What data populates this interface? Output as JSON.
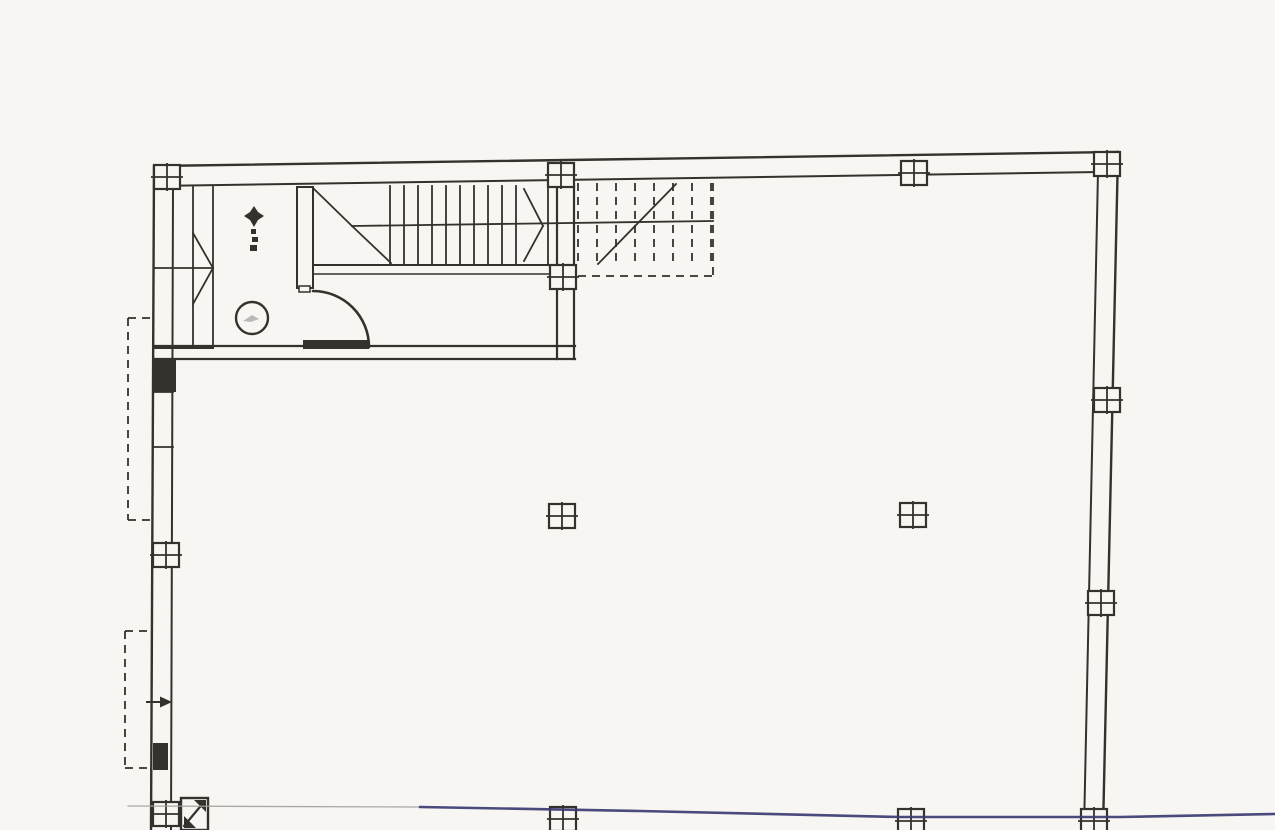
{
  "meta": {
    "width": 1275,
    "height": 830,
    "paper_color": "#f7f6f3",
    "ink_color": "#35312d",
    "pen_blue_color": "#3b3b72",
    "pen_gray_color": "#a0a09c",
    "drawing_type": "scanned-floor-plan",
    "visible_text": []
  },
  "floorplan": {
    "lines": [
      {
        "n": "top-wall-outer",
        "p": [
          155,
          166,
          1118,
          152
        ],
        "w": 2.4
      },
      {
        "n": "top-wall-inner",
        "p": [
          155,
          186,
          1098,
          172
        ],
        "w": 2
      },
      {
        "n": "right-wall-outer",
        "p": [
          1118,
          152,
          1103,
          830
        ],
        "w": 2.4
      },
      {
        "n": "right-wall-inner",
        "p": [
          1098,
          172,
          1084,
          830
        ],
        "w": 2
      },
      {
        "n": "left-wall-outer",
        "p": [
          154,
          166,
          151,
          830
        ],
        "w": 2.4
      },
      {
        "n": "left-wall-inner",
        "p": [
          173,
          186,
          171,
          830
        ],
        "w": 2
      },
      {
        "n": "lobby-south-wall-top-left",
        "p": [
          154,
          346,
          307,
          346
        ],
        "w": 2.2
      },
      {
        "n": "lobby-south-wall-top-right",
        "p": [
          368,
          346,
          575,
          346
        ],
        "w": 2.2
      },
      {
        "n": "lobby-south-wall-bottom",
        "p": [
          154,
          359,
          575,
          359
        ],
        "w": 2.2
      },
      {
        "n": "lobby-east-wall-outer",
        "p": [
          574,
          186,
          574,
          359
        ],
        "w": 2.2
      },
      {
        "n": "lobby-east-wall-inner",
        "p": [
          557,
          186,
          557,
          359
        ],
        "w": 2.2
      },
      {
        "n": "left-wall-division",
        "p": [
          154,
          392,
          173,
          392
        ],
        "w": 1.8
      },
      {
        "n": "left-wall-division",
        "p": [
          154,
          447,
          173,
          447
        ],
        "w": 1.8
      },
      {
        "n": "stair-strip-line",
        "p": [
          193,
          187,
          193,
          348
        ],
        "w": 1.8
      },
      {
        "n": "stair-strip-line",
        "p": [
          213,
          187,
          213,
          348
        ],
        "w": 1.8
      },
      {
        "n": "stair-strip-mid-line",
        "p": [
          154,
          268,
          213,
          268
        ],
        "w": 1.8
      },
      {
        "n": "stair-strip-break-line",
        "p": [
          193,
          233,
          213,
          268
        ],
        "w": 1.8
      },
      {
        "n": "stair-strip-break-line",
        "p": [
          193,
          304,
          213,
          268
        ],
        "w": 1.8
      },
      {
        "n": "stair-strip-bottom-line",
        "p": [
          154,
          348,
          213,
          348
        ],
        "w": 2
      },
      {
        "n": "stair-flight-bottom-line",
        "p": [
          313,
          265,
          557,
          265
        ],
        "w": 2
      },
      {
        "n": "stair-landing-line",
        "p": [
          313,
          274,
          552,
          274
        ],
        "w": 1.6
      },
      {
        "n": "stair-mid-line",
        "p": [
          352,
          226,
          713,
          221
        ],
        "w": 1.8
      },
      {
        "n": "stair-break-line",
        "p": [
          313,
          188,
          352,
          226
        ],
        "w": 1.8
      },
      {
        "n": "stair-break-line",
        "p": [
          352,
          226,
          391,
          263
        ],
        "w": 1.8
      },
      {
        "n": "stair-break-line",
        "p": [
          524,
          189,
          543,
          226
        ],
        "w": 1.8
      },
      {
        "n": "stair-break-line",
        "p": [
          543,
          226,
          524,
          261
        ],
        "w": 1.8
      },
      {
        "n": "stair-tread",
        "p": [
          390,
          186,
          390,
          264
        ],
        "w": 1.8
      },
      {
        "n": "stair-tread",
        "p": [
          404,
          186,
          404,
          264
        ],
        "w": 1.8
      },
      {
        "n": "stair-tread",
        "p": [
          418,
          186,
          418,
          264
        ],
        "w": 1.8
      },
      {
        "n": "stair-tread",
        "p": [
          432,
          186,
          432,
          264
        ],
        "w": 1.8
      },
      {
        "n": "stair-tread",
        "p": [
          446,
          186,
          446,
          264
        ],
        "w": 1.8
      },
      {
        "n": "stair-tread",
        "p": [
          460,
          186,
          460,
          264
        ],
        "w": 1.8
      },
      {
        "n": "stair-tread",
        "p": [
          474,
          186,
          474,
          264
        ],
        "w": 1.8
      },
      {
        "n": "stair-tread",
        "p": [
          488,
          186,
          488,
          264
        ],
        "w": 1.8
      },
      {
        "n": "stair-tread",
        "p": [
          502,
          186,
          502,
          264
        ],
        "w": 1.8
      },
      {
        "n": "stair-tread",
        "p": [
          516,
          186,
          516,
          264
        ],
        "w": 1.8
      },
      {
        "n": "stair-tread",
        "p": [
          548,
          186,
          548,
          264
        ],
        "w": 1.8
      },
      {
        "n": "upper-stair-direction-line",
        "p": [
          598,
          264,
          676,
          184
        ],
        "w": 1.8
      },
      {
        "n": "door-jamb-divider",
        "p": [
          297,
          253,
          313,
          253
        ],
        "w": 1.8
      },
      {
        "n": "entrance-arrow-shaft",
        "p": [
          147,
          702,
          163,
          702
        ],
        "w": 2
      }
    ],
    "dashed_lines": [
      {
        "n": "upper-stair-tread",
        "p": [
          578,
          183,
          578,
          264
        ]
      },
      {
        "n": "upper-stair-tread",
        "p": [
          597,
          183,
          597,
          264
        ]
      },
      {
        "n": "upper-stair-tread",
        "p": [
          616,
          183,
          616,
          264
        ]
      },
      {
        "n": "upper-stair-tread",
        "p": [
          635,
          183,
          635,
          264
        ]
      },
      {
        "n": "upper-stair-tread",
        "p": [
          654,
          183,
          654,
          264
        ]
      },
      {
        "n": "upper-stair-tread",
        "p": [
          673,
          183,
          673,
          264
        ]
      },
      {
        "n": "upper-stair-tread",
        "p": [
          692,
          183,
          692,
          264
        ]
      },
      {
        "n": "upper-stair-tread",
        "p": [
          711,
          183,
          711,
          264
        ]
      },
      {
        "n": "upper-stair-outline",
        "p": [
          578,
          276,
          713,
          276
        ]
      },
      {
        "n": "upper-stair-outline",
        "p": [
          713,
          183,
          713,
          276
        ]
      },
      {
        "n": "canopy-dashed-outline",
        "p": [
          128,
          318,
          128,
          520
        ]
      },
      {
        "n": "canopy-dashed-outline",
        "p": [
          128,
          318,
          154,
          318
        ]
      },
      {
        "n": "canopy-dashed-outline",
        "p": [
          128,
          520,
          154,
          520
        ]
      },
      {
        "n": "canopy-dashed-outline",
        "p": [
          125,
          631,
          125,
          768
        ]
      },
      {
        "n": "canopy-dashed-outline",
        "p": [
          125,
          631,
          152,
          631
        ]
      },
      {
        "n": "canopy-dashed-outline",
        "p": [
          125,
          768,
          152,
          768
        ]
      }
    ],
    "rects": [
      {
        "n": "door-jamb",
        "x": 297,
        "y": 187,
        "w": 16,
        "h": 101,
        "stroke": true,
        "sw": 2
      },
      {
        "n": "door-jamb-foot",
        "x": 299,
        "y": 286,
        "w": 11,
        "h": 6,
        "stroke": true,
        "sw": 1.5
      },
      {
        "n": "door-leaf",
        "x": 303,
        "y": 340,
        "w": 66,
        "h": 9,
        "fill": true
      },
      {
        "n": "wall-pier",
        "x": 154,
        "y": 360,
        "w": 22,
        "h": 32,
        "fill": true
      },
      {
        "n": "wall-pier",
        "x": 153,
        "y": 743,
        "w": 15,
        "h": 27,
        "fill": true
      },
      {
        "n": "hatched-column",
        "x": 181,
        "y": 798,
        "w": 27,
        "h": 32,
        "stroke": true,
        "sw": 2.4
      },
      {
        "n": "level-text-smudge",
        "x": 251,
        "y": 229,
        "w": 5,
        "h": 5,
        "fill": true
      },
      {
        "n": "level-text-smudge",
        "x": 252,
        "y": 237,
        "w": 6,
        "h": 5,
        "fill": true
      },
      {
        "n": "level-text-smudge",
        "x": 250,
        "y": 245,
        "w": 7,
        "h": 6,
        "fill": true
      }
    ],
    "paths": [
      {
        "n": "door-swing-arc",
        "d": "M 313,291 A 56 56 0 0 1 369,347",
        "w": 2.6
      },
      {
        "n": "level-marker-star-icon",
        "d": "M254,206 L258,212 L264,216 L258,220 L254,227 L250,220 L244,216 L250,212 Z",
        "fill": true
      },
      {
        "n": "wc-scribble",
        "d": "M243,321 l9,-6 l7,4 l-8,3 Z",
        "fill": true,
        "c": "#8a8782",
        "o": 0.55
      },
      {
        "n": "entrance-arrow-head-icon",
        "d": "M160,696.5 L172,702 L160,707.5 Z",
        "fill": true
      },
      {
        "n": "hatched-column-mark",
        "d": "M206,800 L206,812 L194,800 Z",
        "fill": true
      },
      {
        "n": "hatched-column-mark",
        "d": "M184,828 L184,816 L196,828 Z",
        "fill": true
      },
      {
        "n": "hatched-column-diagonal",
        "d": "M184,826 L204,802",
        "w": 2.2
      }
    ],
    "circles": [
      {
        "n": "wc-fixture-circle",
        "cx": 252,
        "cy": 318,
        "r": 16,
        "w": 2.4
      }
    ],
    "column_markers": [
      {
        "n": "column-marker",
        "cx": 167,
        "cy": 177
      },
      {
        "n": "column-marker",
        "cx": 561,
        "cy": 175
      },
      {
        "n": "column-marker",
        "cx": 914,
        "cy": 173
      },
      {
        "n": "column-marker",
        "cx": 1107,
        "cy": 164
      },
      {
        "n": "column-marker",
        "cx": 563,
        "cy": 277
      },
      {
        "n": "column-marker",
        "cx": 1107,
        "cy": 400
      },
      {
        "n": "column-marker",
        "cx": 1101,
        "cy": 603
      },
      {
        "n": "column-marker",
        "cx": 1094,
        "cy": 821
      },
      {
        "n": "column-marker",
        "cx": 562,
        "cy": 516
      },
      {
        "n": "column-marker",
        "cx": 913,
        "cy": 515
      },
      {
        "n": "column-marker",
        "cx": 166,
        "cy": 555
      },
      {
        "n": "column-marker",
        "cx": 166,
        "cy": 814
      },
      {
        "n": "column-marker",
        "cx": 563,
        "cy": 819
      },
      {
        "n": "column-marker",
        "cx": 911,
        "cy": 821
      }
    ],
    "pen_lines": [
      {
        "n": "pen-annotation-gray",
        "pts": "128,806 420,807",
        "c": "#a0a09c",
        "w": 1.3,
        "o": 0.9
      },
      {
        "n": "pen-annotation-blue",
        "pts": "420,807 640,811 900,817 1120,817 1275,814",
        "c": "#3b3b72",
        "w": 2.6,
        "o": 0.92
      }
    ]
  }
}
